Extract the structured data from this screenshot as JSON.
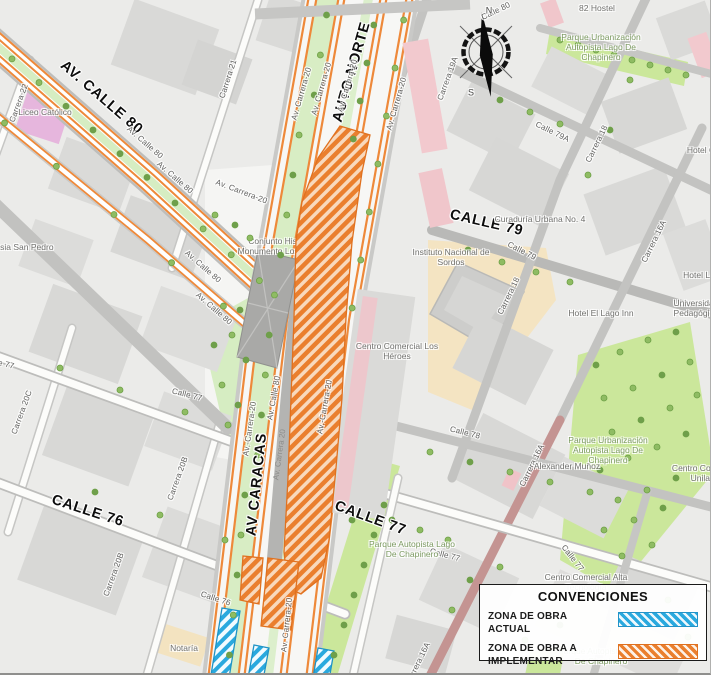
{
  "legend": {
    "title": "CONVENCIONES",
    "items": [
      {
        "label": "ZONA DE OBRA ACTUAL",
        "swatch": "blue"
      },
      {
        "label": "ZONA DE OBRA A IMPLEMENTAR",
        "swatch": "orange"
      }
    ]
  },
  "colors": {
    "obra_actual": "#2aa9de",
    "obra_implementar": "#ea7f2e",
    "park_green": "#cbe79b",
    "road_orange": "#ee893a"
  },
  "compass": {
    "north": "N",
    "south": "S"
  },
  "map": {
    "labels": [
      {
        "t": "AV. CALLE 80",
        "x": 62,
        "y": 64,
        "r": 41,
        "c": "major",
        "a": "l"
      },
      {
        "t": "AUTO NORTE",
        "x": 338,
        "y": 122,
        "r": -74,
        "c": "major",
        "a": "l"
      },
      {
        "t": "CALLE 79",
        "x": 450,
        "y": 215,
        "r": 13,
        "c": "major",
        "a": "l"
      },
      {
        "t": "AV CARACAS",
        "x": 252,
        "y": 536,
        "r": -84,
        "c": "major",
        "a": "l"
      },
      {
        "t": "CALLE 76",
        "x": 52,
        "y": 500,
        "r": 18,
        "c": "major",
        "a": "l"
      },
      {
        "t": "CALLE 77",
        "x": 335,
        "y": 506,
        "r": 20,
        "c": "major",
        "a": "l"
      },
      {
        "t": "Carrera 22",
        "x": 12,
        "y": 122,
        "r": -70,
        "c": "road",
        "a": "l"
      },
      {
        "t": "Carrera 21",
        "x": 222,
        "y": 98,
        "r": -72,
        "c": "road",
        "a": "l"
      },
      {
        "t": "Av. Carrera-20",
        "x": 294,
        "y": 120,
        "r": -74,
        "c": "road",
        "a": "l"
      },
      {
        "t": "Av. Carrera-20",
        "x": 314,
        "y": 115,
        "r": -74,
        "c": "road",
        "a": "l"
      },
      {
        "t": "Av. Carrera-20",
        "x": 340,
        "y": 112,
        "r": -74,
        "c": "road",
        "a": "l"
      },
      {
        "t": "Av. Carrera-20",
        "x": 389,
        "y": 130,
        "r": -74,
        "c": "road",
        "a": "l"
      },
      {
        "t": "Av. Calle 80",
        "x": 128,
        "y": 128,
        "r": 41,
        "c": "road",
        "a": "l"
      },
      {
        "t": "Av. Calle 80",
        "x": 158,
        "y": 163,
        "r": 41,
        "c": "road",
        "a": "l"
      },
      {
        "t": "Av. Calle 80",
        "x": 186,
        "y": 252,
        "r": 41,
        "c": "road",
        "a": "l"
      },
      {
        "t": "Av. Calle 80",
        "x": 197,
        "y": 294,
        "r": 41,
        "c": "road",
        "a": "l"
      },
      {
        "t": "Av. Carrera-20",
        "x": 216,
        "y": 182,
        "r": 21,
        "c": "road",
        "a": "l"
      },
      {
        "t": "Carrera 19A",
        "x": 440,
        "y": 100,
        "r": -70,
        "c": "road",
        "a": "l"
      },
      {
        "t": "Calle 80",
        "x": 482,
        "y": 18,
        "r": -26,
        "c": "road",
        "a": "l"
      },
      {
        "t": "Calle 79A",
        "x": 536,
        "y": 124,
        "r": 26,
        "c": "road",
        "a": "l"
      },
      {
        "t": "Carrera 18",
        "x": 588,
        "y": 162,
        "r": -64,
        "c": "road",
        "a": "l"
      },
      {
        "t": "Carrera 18",
        "x": 500,
        "y": 314,
        "r": -64,
        "c": "road",
        "a": "l"
      },
      {
        "t": "Calle 79",
        "x": 508,
        "y": 244,
        "r": 27,
        "c": "road",
        "a": "l"
      },
      {
        "t": "Carrera 16A",
        "x": 644,
        "y": 262,
        "r": -64,
        "c": "road",
        "a": "l"
      },
      {
        "t": "Carrera 16A",
        "x": 522,
        "y": 486,
        "r": -64,
        "c": "road",
        "a": "l"
      },
      {
        "t": "Carrera 16A",
        "x": 408,
        "y": 684,
        "r": -64,
        "c": "road",
        "a": "l"
      },
      {
        "t": "Calle 78",
        "x": 450,
        "y": 429,
        "r": 14,
        "c": "road",
        "a": "l"
      },
      {
        "t": "Calle 77",
        "x": 430,
        "y": 551,
        "r": 15,
        "c": "road",
        "a": "l"
      },
      {
        "t": "Calle 77",
        "x": 563,
        "y": 546,
        "r": 52,
        "c": "road",
        "a": "l"
      },
      {
        "t": "Calle 77",
        "x": 172,
        "y": 391,
        "r": 14,
        "c": "road",
        "a": "l"
      },
      {
        "t": "Calle 77",
        "x": -16,
        "y": 359,
        "r": 14,
        "c": "road",
        "a": "l"
      },
      {
        "t": "Calle 76",
        "x": 201,
        "y": 594,
        "r": 18,
        "c": "road",
        "a": "l"
      },
      {
        "t": "Carrera 20C",
        "x": 14,
        "y": 434,
        "r": -70,
        "c": "road",
        "a": "l"
      },
      {
        "t": "Carrera 20B",
        "x": 170,
        "y": 500,
        "r": -70,
        "c": "road",
        "a": "l"
      },
      {
        "t": "Carrera 20B",
        "x": 106,
        "y": 596,
        "r": -70,
        "c": "road",
        "a": "l"
      },
      {
        "t": "Av.-Carrera-20",
        "x": 246,
        "y": 456,
        "r": -82,
        "c": "road",
        "a": "l"
      },
      {
        "t": "Av. Calle 80",
        "x": 270,
        "y": 420,
        "r": -80,
        "c": "road",
        "a": "l"
      },
      {
        "t": "Av.-Carrera-20",
        "x": 320,
        "y": 434,
        "r": -80,
        "c": "road",
        "a": "l"
      },
      {
        "t": "Av. Carrera 20",
        "x": 276,
        "y": 480,
        "r": -82,
        "c": "roadw",
        "a": "l"
      },
      {
        "t": "Av. Carrera-20",
        "x": 284,
        "y": 652,
        "r": -84,
        "c": "road",
        "a": "l"
      },
      {
        "t": "Liceo Católico",
        "x": 45,
        "y": 112,
        "r": 0,
        "c": "poi",
        "a": "c"
      },
      {
        "t": "Iglesia San Pedro",
        "x": 20,
        "y": 247,
        "r": 0,
        "c": "poi",
        "a": "c"
      },
      {
        "t": "82 Hostel",
        "x": 597,
        "y": 8,
        "r": 0,
        "c": "poi",
        "a": "c"
      },
      {
        "t": "Parque Urbanización\nAutopista Lago De\nChapinero",
        "x": 601,
        "y": 47,
        "r": 0,
        "c": "park",
        "a": "c"
      },
      {
        "t": "Curaduría Urbana No. 4",
        "x": 540,
        "y": 219,
        "r": 0,
        "c": "poi",
        "a": "c"
      },
      {
        "t": "Hotel El Lago Inn",
        "x": 601,
        "y": 313,
        "r": 0,
        "c": "poi",
        "a": "c"
      },
      {
        "t": "Hotel C",
        "x": 701,
        "y": 150,
        "r": 0,
        "c": "poi",
        "a": "c"
      },
      {
        "t": "Hotel La",
        "x": 699,
        "y": 275,
        "r": 0,
        "c": "poi",
        "a": "c"
      },
      {
        "t": "Universidad\nPedagógica",
        "x": 696,
        "y": 308,
        "r": 0,
        "c": "poi",
        "a": "c"
      },
      {
        "t": "Instituto Nacional de\nSordos",
        "x": 451,
        "y": 257,
        "r": 0,
        "c": "poi",
        "a": "c"
      },
      {
        "t": "Centro Comercial Los\nHéroes",
        "x": 397,
        "y": 351,
        "r": 0,
        "c": "poi",
        "a": "c"
      },
      {
        "t": "Alexander Muñoz",
        "x": 567,
        "y": 466,
        "r": 0,
        "c": "poi",
        "a": "c"
      },
      {
        "t": "Parque Urbanización\nAutopista Lago De\nChapinero",
        "x": 608,
        "y": 450,
        "r": 0,
        "c": "park",
        "a": "c"
      },
      {
        "t": "Centro Comercial\nUnilago",
        "x": 705,
        "y": 473,
        "r": 0,
        "c": "poi",
        "a": "c"
      },
      {
        "t": "Parque Autopista Lago\nDe Chapinero",
        "x": 412,
        "y": 549,
        "r": 0,
        "c": "park",
        "a": "c"
      },
      {
        "t": "Centro Comercial Alta\nTecnología",
        "x": 586,
        "y": 582,
        "r": 0,
        "c": "poi",
        "a": "c"
      },
      {
        "t": "Parque Autopista Lago\nDe Chapinero",
        "x": 601,
        "y": 656,
        "r": 0,
        "c": "park",
        "a": "c"
      },
      {
        "t": "Notaría",
        "x": 184,
        "y": 648,
        "r": 0,
        "c": "poi",
        "a": "c"
      },
      {
        "t": "Conjunto Histórico\nMonumento Los Héroes",
        "x": 283,
        "y": 246,
        "r": 0,
        "c": "poi",
        "a": "c",
        "u": true
      },
      {
        "t": "N",
        "x": 489,
        "y": 11,
        "r": 0,
        "c": "cmp",
        "a": "c"
      },
      {
        "t": "S",
        "x": 471,
        "y": 93,
        "r": 0,
        "c": "cmp",
        "a": "c"
      }
    ]
  }
}
